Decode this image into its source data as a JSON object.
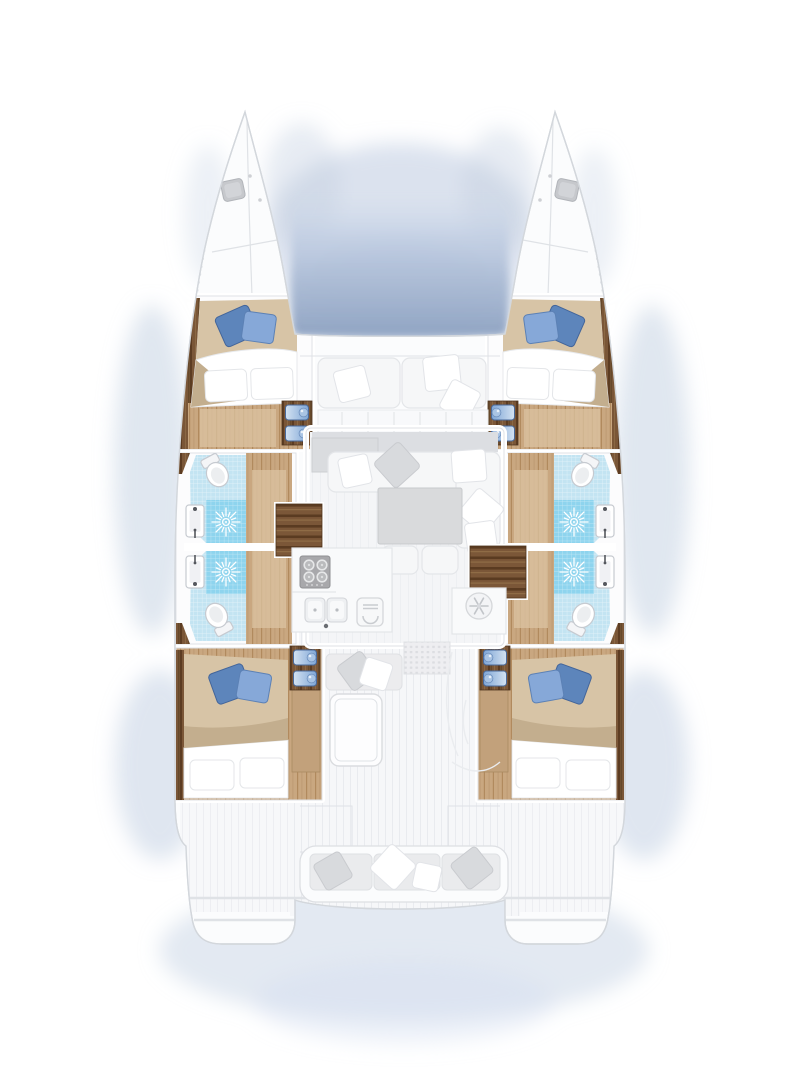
{
  "diagram": {
    "type": "floor-plan",
    "label": "Catamaran yacht deck and accommodation plan, top-down view",
    "view": "top-down",
    "counts": {
      "cabins": 4,
      "bathrooms": 4
    }
  },
  "colors": {
    "hull_white": "#fbfcfd",
    "outline": "#d3d7dc",
    "hairline": "#dfe2e6",
    "shadow_blue": "#b8c7de",
    "shadow_blue_soft": "#cfdaeb",
    "trampoline_top": "#dde5f1",
    "trampoline_bottom": "#93a6c4",
    "wood_dark": "#7a5637",
    "wood_dark_stripe": "#5c3c22",
    "wood_floor": "#c9a780",
    "wood_floor_stripe": "#b18a5e",
    "rug_light": "#dbc3a2",
    "duvet_beige": "#d7c4a6",
    "duvet_shade": "#c3ae8e",
    "pillow_blue_dark": "#5d85bb",
    "pillow_blue_light": "#86a8d8",
    "tile_light": "#c3e4f2",
    "tile_shower": "#8ed4ee",
    "fixture_white": "#f4f5f7",
    "fixture_stroke": "#c6cad0",
    "sofa_white": "#f6f7f8",
    "cushion_gray": "#d8dadd",
    "table_gray": "#d9dadc",
    "appliance_gray": "#a8a8ab",
    "roof_gray": "#dcdee2",
    "deck_base": "#f6f7f9",
    "deck_stripe": "#e9ebef"
  },
  "rooms": {
    "foredeck": {
      "features": [
        "trampoline-water-shadow",
        "sun-bench-cushions",
        "throw-pillows"
      ]
    },
    "bow_port": {
      "features": [
        "deck-hatch",
        "deck-seam-lines"
      ]
    },
    "bow_starboard": {
      "features": [
        "deck-hatch",
        "deck-seam-lines"
      ]
    },
    "forward_cabin_port": {
      "features": [
        "double-bed",
        "blue-throw-pillows",
        "wardrobe",
        "entry-steps"
      ]
    },
    "forward_cabin_starboard": {
      "features": [
        "double-bed",
        "blue-throw-pillows",
        "wardrobe",
        "entry-steps"
      ]
    },
    "bathroom_port_forward": {
      "features": [
        "toilet",
        "shower",
        "washbasin"
      ]
    },
    "bathroom_port_aft": {
      "features": [
        "toilet",
        "shower",
        "washbasin"
      ]
    },
    "bathroom_starboard_forward": {
      "features": [
        "toilet",
        "shower",
        "washbasin"
      ]
    },
    "bathroom_starboard_aft": {
      "features": [
        "toilet",
        "shower",
        "washbasin"
      ]
    },
    "aft_cabin_port": {
      "features": [
        "double-bed",
        "blue-throw-pillows",
        "entry-steps",
        "side-shelf"
      ]
    },
    "aft_cabin_starboard": {
      "features": [
        "double-bed",
        "blue-throw-pillows",
        "entry-steps",
        "side-shelf"
      ]
    },
    "salon": {
      "features": [
        "l-shaped-sofa",
        "coffee-table",
        "two-stools",
        "sideboard",
        "companionway-steps-port",
        "companionway-steps-starboard"
      ]
    },
    "galley": {
      "features": [
        "four-burner-stove",
        "double-sink",
        "oven",
        "refrigerator"
      ]
    },
    "cockpit": {
      "features": [
        "bench-seat",
        "cockpit-table",
        "door-mat",
        "helm-sketch"
      ]
    },
    "aft_deck": {
      "features": [
        "transom-bench",
        "swim-platform-port",
        "swim-platform-starboard",
        "davit-lines"
      ]
    }
  }
}
